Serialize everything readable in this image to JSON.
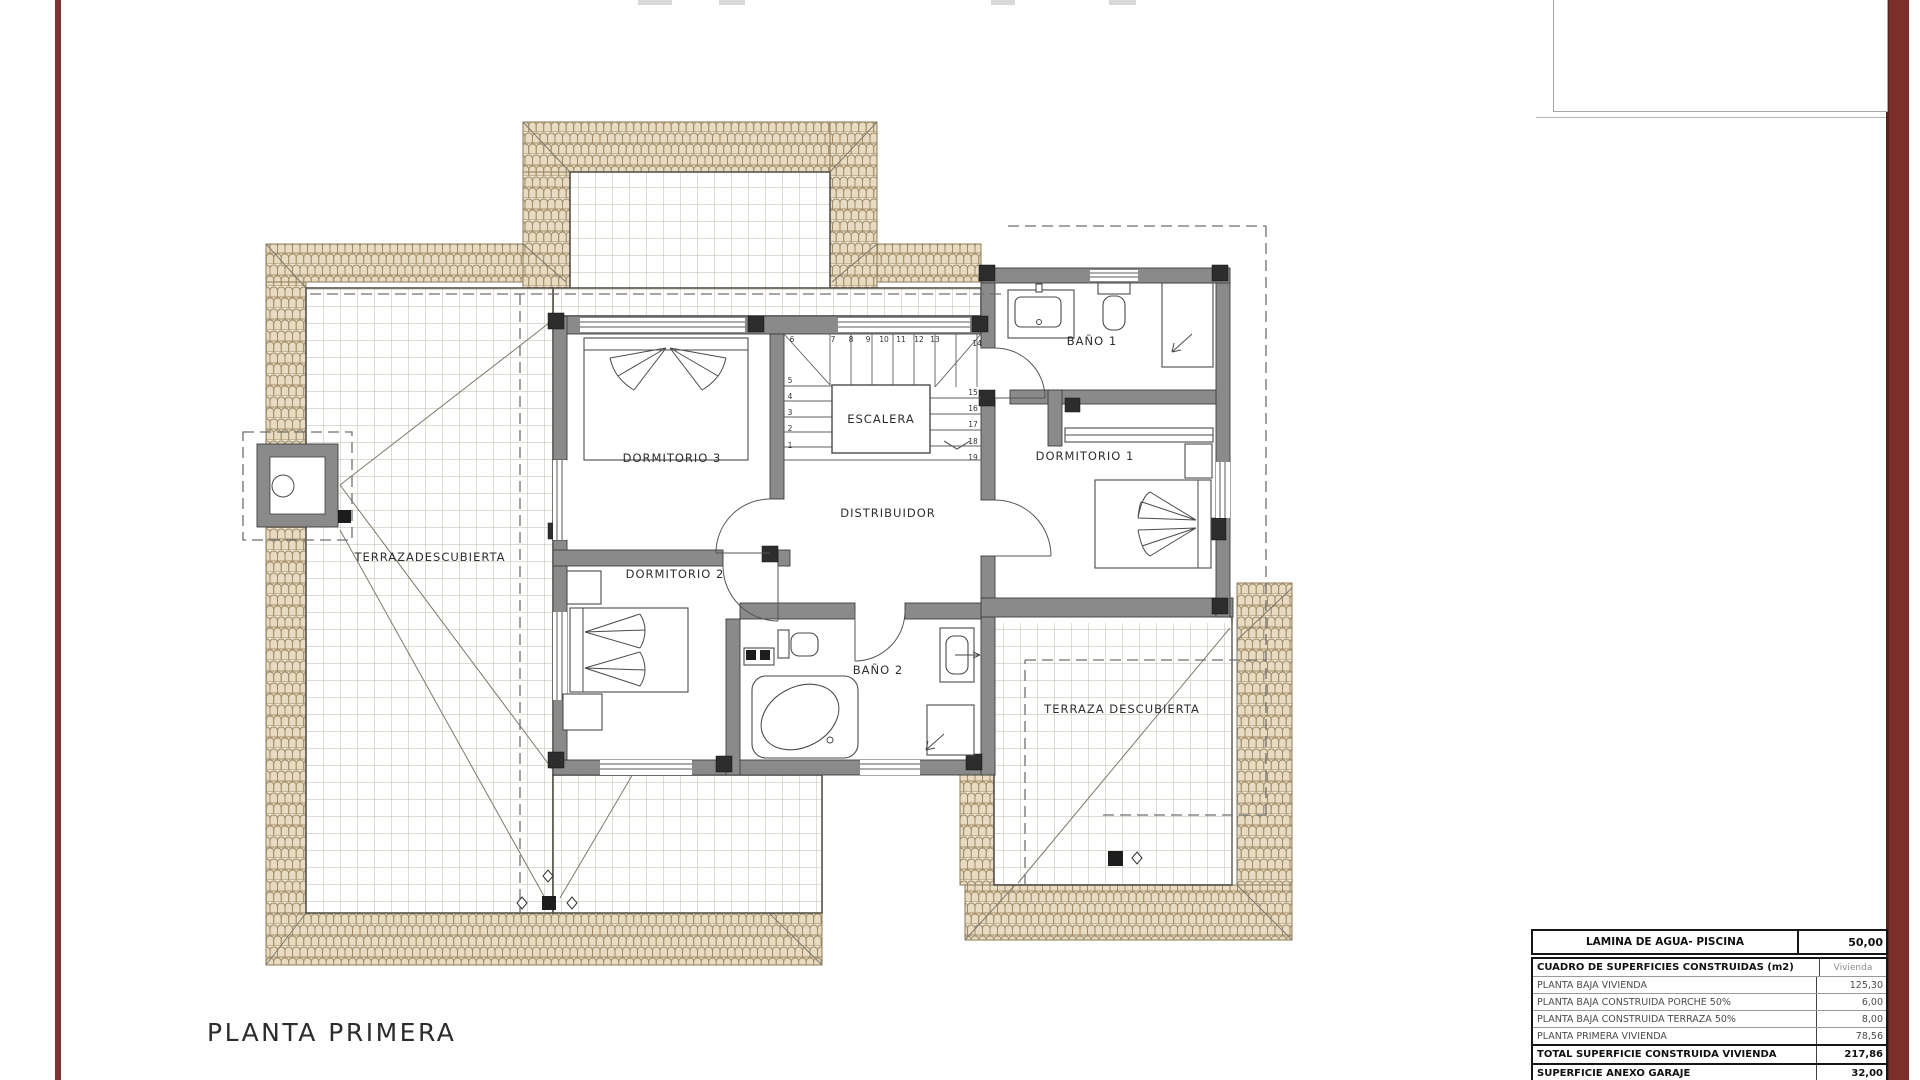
{
  "page": {
    "title": "PLANTA PRIMERA"
  },
  "colors": {
    "accent_red": "#7b2f2b",
    "tile_fill": "#efe6d2",
    "tile_stroke": "#a08b66",
    "grid_line": "#c0b9ab",
    "wall_gray": "#8a8a8a"
  },
  "plan": {
    "rooms": {
      "dormitorio3": "DORMITORIO 3",
      "dormitorio2": "DORMITORIO 2",
      "dormitorio1": "DORMITORIO 1",
      "bano1": "BAÑO 1",
      "bano2": "BAÑO 2",
      "escalera": "ESCALERA",
      "distribuidor": "DISTRIBUIDOR",
      "terraza_izquierda": "TERRAZADESCUBIERTA",
      "terraza_derecha": "TERRAZA DESCUBIERTA"
    },
    "stairs": {
      "numbers": [
        "1",
        "2",
        "3",
        "4",
        "5",
        "6",
        "7",
        "8",
        "9",
        "10",
        "11",
        "12",
        "13",
        "14",
        "15",
        "16",
        "17",
        "18",
        "19"
      ]
    }
  },
  "tables": {
    "pool": {
      "label": "LAMINA DE AGUA- PISCINA",
      "value": "50,00"
    },
    "surfaces": {
      "header": {
        "label": "CUADRO DE SUPERFICIES CONSTRUIDAS (m2)",
        "unit": "Vivienda"
      },
      "rows": [
        {
          "label": "PLANTA BAJA VIVIENDA",
          "value": "125,30"
        },
        {
          "label": "PLANTA BAJA CONSTRUIDA PORCHE 50%",
          "value": "6,00"
        },
        {
          "label": "PLANTA BAJA CONSTRUIDA TERRAZA 50%",
          "value": "8,00"
        },
        {
          "label": "PLANTA PRIMERA VIVIENDA",
          "value": "78,56"
        }
      ],
      "total": {
        "label": "TOTAL SUPERFICIE CONSTRUIDA VIVIENDA",
        "value": "217,86"
      },
      "annex": [
        {
          "label": "SUPERFICIE ANEXO GARAJE",
          "value": "32,00"
        },
        {
          "label": "SUPERFICIE ANEXO BARBACOA",
          "value": "15,00"
        }
      ]
    }
  }
}
